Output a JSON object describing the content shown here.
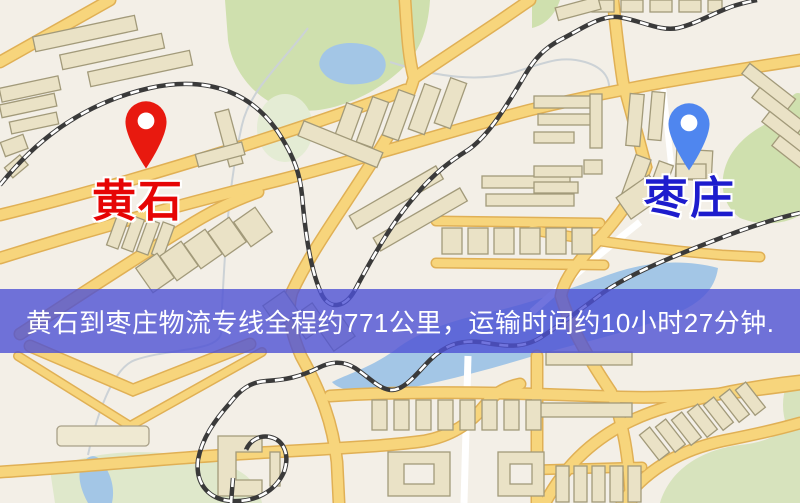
{
  "map": {
    "origin": {
      "name": "黄石",
      "label_color": "#e60505"
    },
    "destination": {
      "name": "枣庄",
      "label_color": "#1d1ccd"
    },
    "pins": {
      "origin": {
        "color": "#e8190f"
      },
      "destination": {
        "color": "#4f86ef"
      }
    }
  },
  "banner": {
    "text": "黄石到枣庄物流专线全程约771公里，运输时间约10小时27分钟.",
    "distance_km": "771",
    "duration_hours": "10",
    "duration_minutes": "27",
    "background": "rgba(77,81,213,0.8)",
    "text_color": "#ffffff"
  },
  "map_colors": {
    "background": "#f3efe7",
    "road_fill": "#f7d57c",
    "road_border": "#e0b055",
    "minor_road": "#ffffff",
    "water": "#a3c6e6",
    "park": "#cfe0ae",
    "building_fill": "#eae2c6",
    "building_outline": "#a29a7a",
    "railway": "#3a3a3a"
  }
}
